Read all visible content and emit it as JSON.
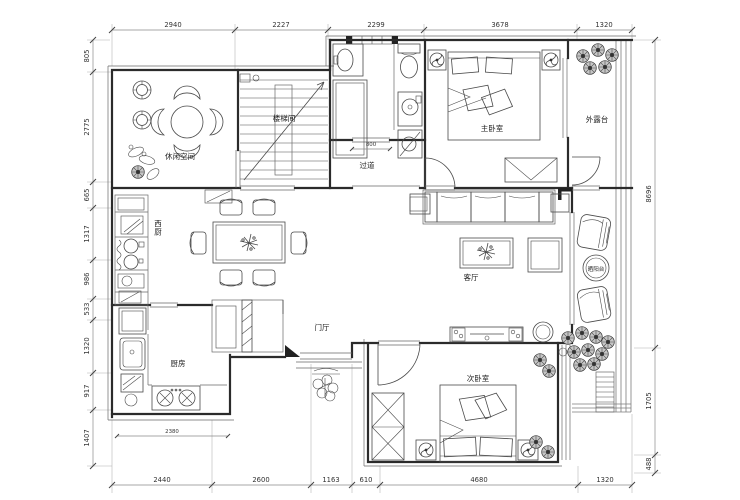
{
  "plan": {
    "rooms": {
      "leisure": "休闲空间",
      "stairwell": "楼梯间",
      "corridor": "过道",
      "master_bedroom": "主卧室",
      "outer_terrace": "外露台",
      "west_kitchen": "西厨",
      "living_room": "客厅",
      "sun_balcony": "晒阳台",
      "entry_hall": "门厅",
      "kitchen": "厨房",
      "second_bedroom": "次卧室"
    },
    "dims": {
      "top": [
        "2940",
        "2227",
        "2299",
        "3678",
        "1320"
      ],
      "left": [
        "805",
        "2775",
        "665",
        "1317",
        "986",
        "533",
        "1320",
        "917",
        "1407"
      ],
      "right": [
        "8696",
        "1705",
        "488"
      ],
      "bottom": [
        "2440",
        "2600",
        "1163",
        "610",
        "4680",
        "1320"
      ],
      "inner": [
        "800",
        "2380"
      ]
    },
    "colors": {
      "wall": "#2b2b2b",
      "furniture": "#4a4a4a",
      "dimension": "#333333",
      "background": "#ffffff"
    }
  }
}
